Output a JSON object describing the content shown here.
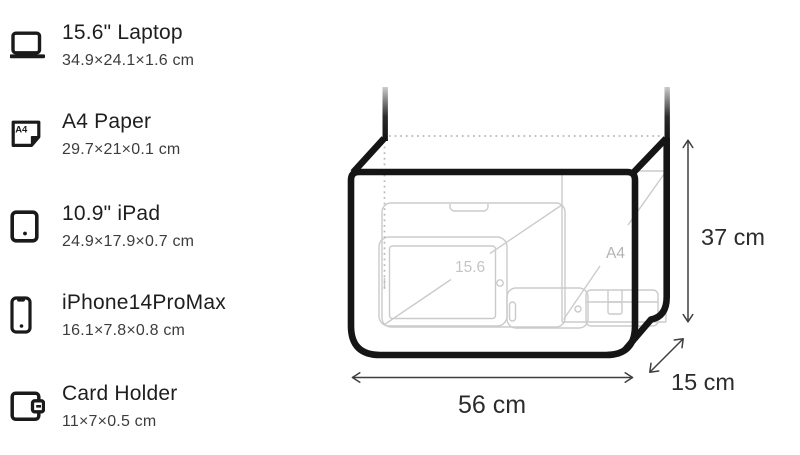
{
  "items": [
    {
      "name": "15.6\" Laptop",
      "dimensions": "34.9×24.1×1.6 cm",
      "icon": "laptop-icon"
    },
    {
      "name": "A4 Paper",
      "dimensions": "29.7×21×0.1 cm",
      "icon": "a4-paper-icon",
      "icon_label": "A4"
    },
    {
      "name": "10.9\" iPad",
      "dimensions": "24.9×17.9×0.7 cm",
      "icon": "ipad-icon"
    },
    {
      "name": "iPhone14ProMax",
      "dimensions": "16.1×7.8×0.8 cm",
      "icon": "iphone-icon"
    },
    {
      "name": "Card Holder",
      "dimensions": "11×7×0.5 cm",
      "icon": "card-holder-icon"
    }
  ],
  "diagram": {
    "width_label": "56 cm",
    "height_label": "37 cm",
    "depth_label": "15 cm",
    "laptop_inner_label": "15.6",
    "paper_inner_label": "A4",
    "colors": {
      "bag_outline": "#151515",
      "item_outline": "#cbcbcb",
      "dimension_text": "#2c2c2c",
      "hidden_edge_dots": "#b9b9b9"
    }
  }
}
